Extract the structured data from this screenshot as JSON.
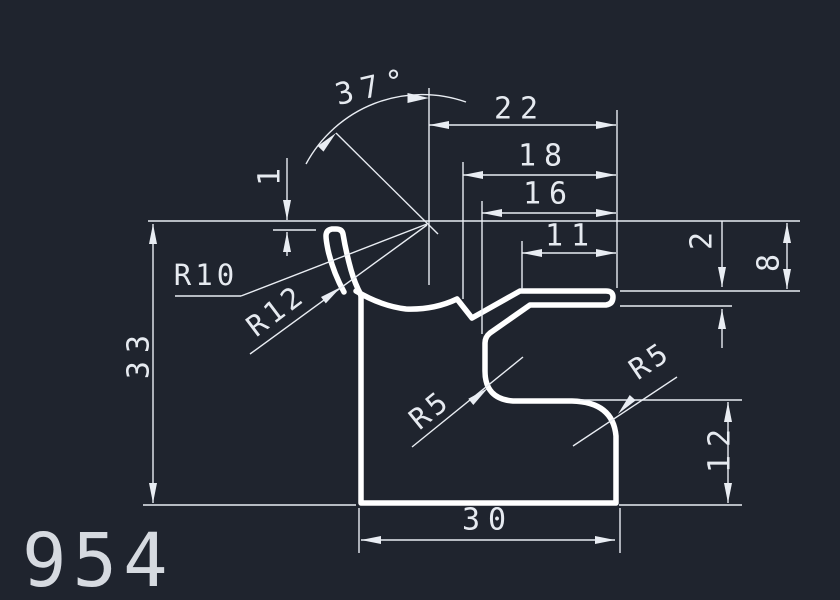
{
  "drawing": {
    "part_number": "954",
    "angle_dim": {
      "label": "37°"
    },
    "linear_dims": {
      "top_width": "22",
      "width_18": "18",
      "width_16": "16",
      "width_11": "11",
      "bottom_width": "30",
      "overall_height": "33",
      "right_height": "12",
      "blade_height": "8",
      "blade_thickness": "2",
      "lip_offset": "1"
    },
    "radius_dims": {
      "r10": "R10",
      "r12": "R12",
      "r5_left": "R5",
      "r5_right": "R5"
    }
  },
  "colors": {
    "background": "#1f242e",
    "dim_line": "#e9edf3",
    "profile_line": "#ffffff",
    "text": "#e6eaf0"
  }
}
